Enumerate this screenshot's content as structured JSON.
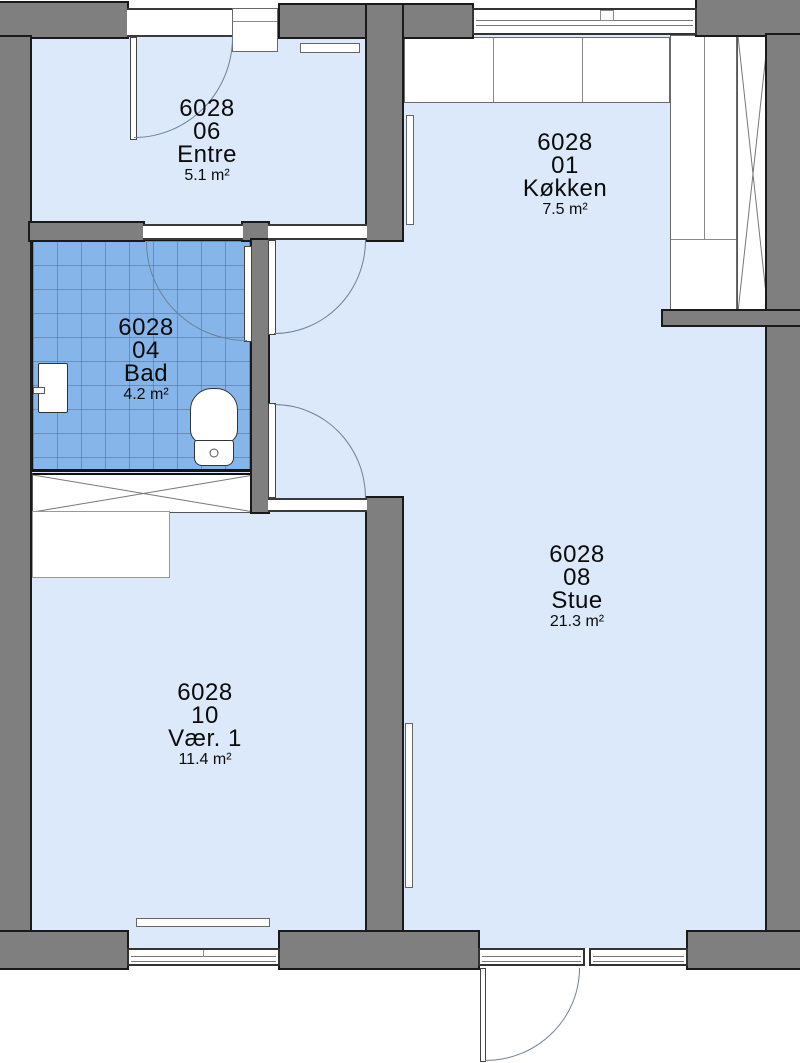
{
  "plan_title": "Apartment floor plan 6028",
  "colors": {
    "wall": "#7f7f7f",
    "floor": "#dbe9fb",
    "tile": "#86b6e9"
  },
  "rooms": [
    {
      "id": "6028",
      "number": "01",
      "name": "Køkken",
      "area": "7.5 m²"
    },
    {
      "id": "6028",
      "number": "04",
      "name": "Bad",
      "area": "4.2 m²"
    },
    {
      "id": "6028",
      "number": "06",
      "name": "Entre",
      "area": "5.1 m²"
    },
    {
      "id": "6028",
      "number": "08",
      "name": "Stue",
      "area": "21.3 m²"
    },
    {
      "id": "6028",
      "number": "10",
      "name": "Vær. 1",
      "area": "11.4 m²"
    }
  ]
}
